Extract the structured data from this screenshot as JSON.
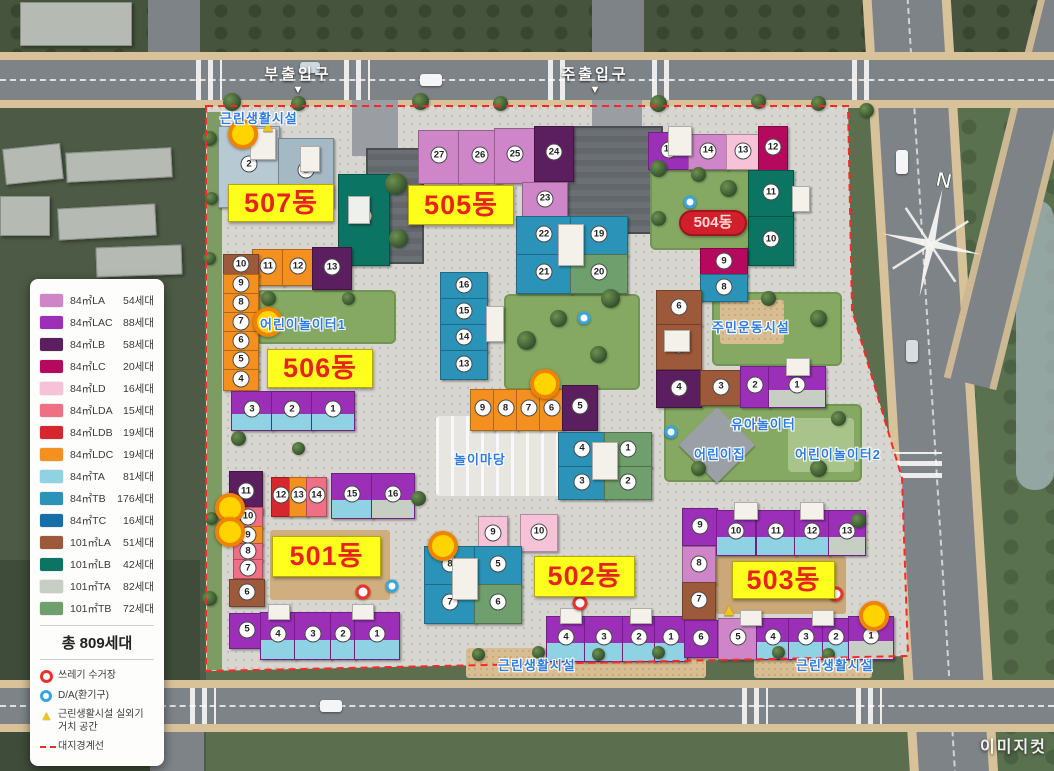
{
  "legend": {
    "unit_types": [
      {
        "label": "84㎡LA",
        "count": "54세대",
        "color": "#cf86c9"
      },
      {
        "label": "84㎡LAC",
        "count": "88세대",
        "color": "#9c2fb8"
      },
      {
        "label": "84㎡LB",
        "count": "58세대",
        "color": "#5b1e5e"
      },
      {
        "label": "84㎡LC",
        "count": "20세대",
        "color": "#b5095e"
      },
      {
        "label": "84㎡LD",
        "count": "16세대",
        "color": "#f6c2d7"
      },
      {
        "label": "84㎡LDA",
        "count": "15세대",
        "color": "#ef6f85"
      },
      {
        "label": "84㎡LDB",
        "count": "19세대",
        "color": "#d7272e"
      },
      {
        "label": "84㎡LDC",
        "count": "19세대",
        "color": "#f39020"
      },
      {
        "label": "84㎡TA",
        "count": "81세대",
        "color": "#8ed2e3"
      },
      {
        "label": "84㎡TB",
        "count": "176세대",
        "color": "#2b93b8"
      },
      {
        "label": "84㎡TC",
        "count": "16세대",
        "color": "#176fa9"
      },
      {
        "label": "101㎡LA",
        "count": "51세대",
        "color": "#9d5a3a"
      },
      {
        "label": "101㎡LB",
        "count": "42세대",
        "color": "#0c7462"
      },
      {
        "label": "101㎡TA",
        "count": "82세대",
        "color": "#c7cfc5"
      },
      {
        "label": "101㎡TB",
        "count": "72세대",
        "color": "#6f9f6c"
      }
    ],
    "total_label": "총 809세대",
    "symbols": [
      {
        "icon": "trash-collection-marker",
        "label": "쓰레기 수거장",
        "color": "#e8332a"
      },
      {
        "icon": "vent-marker",
        "label": "D/A(환기구)",
        "color": "#3aa5dc"
      },
      {
        "icon": "outdoor-unit-area-marker",
        "label": "근린생활시설 실외기 거치 공간",
        "color": "#f2c51d"
      },
      {
        "icon": "site-boundary-line",
        "label": "대지경계선",
        "color": "#e8332a"
      }
    ]
  },
  "entrances": {
    "secondary": "부출입구",
    "main": "주출입구",
    "arrow": "▼"
  },
  "building_labels": {
    "b501": "501동",
    "b502": "502동",
    "b503": "503동",
    "b504": "504동",
    "b505": "505동",
    "b506": "506동",
    "b507": "507동"
  },
  "facilities": {
    "neighborhood_top": "근린생활시설",
    "playground1": "어린이놀이터1",
    "play_yard": "놀이마당",
    "residents_sports": "주민운동시설",
    "toddler_playground": "유아놀이터",
    "daycare": "어린이집",
    "playground2": "어린이놀이터2",
    "neighborhood_bottom_left": "근린생활시설",
    "neighborhood_bottom_right": "근린생활시설"
  },
  "compass_north": "N",
  "watermark": "이미지컷",
  "map_blocks": [
    {
      "n": "2",
      "x": 218,
      "y": 126,
      "w": 60,
      "h": 80,
      "c": "#b7c9d3"
    },
    {
      "n": "1",
      "x": 278,
      "y": 138,
      "w": 54,
      "h": 68,
      "c": "#a5b9c4"
    },
    {
      "n": "",
      "x": 250,
      "y": 128,
      "w": 24,
      "h": 30,
      "c": "#f3f1ea"
    },
    {
      "n": "",
      "x": 300,
      "y": 146,
      "w": 18,
      "h": 24,
      "c": "#f3f1ea"
    },
    {
      "n": "16",
      "x": 338,
      "y": 174,
      "w": 50,
      "h": 90,
      "c": "#0c7462"
    },
    {
      "n": "",
      "x": 348,
      "y": 196,
      "w": 20,
      "h": 26,
      "c": "#eef0ec"
    },
    {
      "n": "11",
      "x": 252,
      "y": 249,
      "w": 30,
      "h": 35,
      "c": "#f39020"
    },
    {
      "n": "12",
      "x": 282,
      "y": 249,
      "w": 30,
      "h": 35,
      "c": "#f39020"
    },
    {
      "n": "13",
      "x": 312,
      "y": 247,
      "w": 38,
      "h": 41,
      "c": "#5b1e5e"
    },
    {
      "n": "10",
      "x": 223,
      "y": 254,
      "w": 34,
      "h": 20,
      "c": "#9d5a3a"
    },
    {
      "n": "9",
      "x": 223,
      "y": 274,
      "w": 34,
      "h": 19,
      "c": "#f39020"
    },
    {
      "n": "8",
      "x": 223,
      "y": 293,
      "w": 34,
      "h": 19,
      "c": "#f39020"
    },
    {
      "n": "7",
      "x": 223,
      "y": 312,
      "w": 34,
      "h": 19,
      "c": "#f39020"
    },
    {
      "n": "6",
      "x": 223,
      "y": 331,
      "w": 34,
      "h": 19,
      "c": "#f39020"
    },
    {
      "n": "5",
      "x": 223,
      "y": 350,
      "w": 34,
      "h": 19,
      "c": "#f39020"
    },
    {
      "n": "4",
      "x": 223,
      "y": 369,
      "w": 34,
      "h": 20,
      "c": "#f39020"
    },
    {
      "n": "3",
      "x": 231,
      "y": 391,
      "w": 40,
      "h": 38,
      "c": "#9c2fb8",
      "l": "#8ed2e3"
    },
    {
      "n": "2",
      "x": 271,
      "y": 391,
      "w": 40,
      "h": 38,
      "c": "#9c2fb8",
      "l": "#8ed2e3"
    },
    {
      "n": "1",
      "x": 311,
      "y": 391,
      "w": 42,
      "h": 38,
      "c": "#9c2fb8",
      "l": "#8ed2e3"
    },
    {
      "n": "27",
      "x": 418,
      "y": 130,
      "w": 40,
      "h": 52,
      "c": "#cf86c9"
    },
    {
      "n": "26",
      "x": 458,
      "y": 130,
      "w": 42,
      "h": 52,
      "c": "#cf86c9"
    },
    {
      "n": "25",
      "x": 494,
      "y": 128,
      "w": 40,
      "h": 54,
      "c": "#cf86c9"
    },
    {
      "n": "24",
      "x": 534,
      "y": 126,
      "w": 38,
      "h": 54,
      "c": "#5b1e5e"
    },
    {
      "n": "23",
      "x": 522,
      "y": 182,
      "w": 44,
      "h": 34,
      "c": "#cf86c9"
    },
    {
      "n": "22",
      "x": 516,
      "y": 216,
      "w": 54,
      "h": 38,
      "c": "#2b93b8"
    },
    {
      "n": "19",
      "x": 570,
      "y": 216,
      "w": 56,
      "h": 38,
      "c": "#2b93b8"
    },
    {
      "n": "21",
      "x": 516,
      "y": 254,
      "w": 54,
      "h": 38,
      "c": "#2b93b8"
    },
    {
      "n": "20",
      "x": 570,
      "y": 254,
      "w": 56,
      "h": 38,
      "c": "#6f9f6c"
    },
    {
      "n": "",
      "x": 558,
      "y": 224,
      "w": 24,
      "h": 40,
      "c": "#f3f1ea"
    },
    {
      "n": "16",
      "x": 440,
      "y": 272,
      "w": 46,
      "h": 26,
      "c": "#2b93b8"
    },
    {
      "n": "15",
      "x": 440,
      "y": 298,
      "w": 46,
      "h": 26,
      "c": "#2b93b8"
    },
    {
      "n": "14",
      "x": 440,
      "y": 324,
      "w": 46,
      "h": 26,
      "c": "#2b93b8"
    },
    {
      "n": "13",
      "x": 440,
      "y": 350,
      "w": 46,
      "h": 28,
      "c": "#2b93b8"
    },
    {
      "n": "",
      "x": 486,
      "y": 306,
      "w": 16,
      "h": 34,
      "c": "#f3f1ea"
    },
    {
      "n": "9",
      "x": 470,
      "y": 389,
      "w": 23,
      "h": 40,
      "c": "#f39020"
    },
    {
      "n": "8",
      "x": 493,
      "y": 389,
      "w": 23,
      "h": 40,
      "c": "#f39020"
    },
    {
      "n": "7",
      "x": 516,
      "y": 389,
      "w": 23,
      "h": 40,
      "c": "#f39020"
    },
    {
      "n": "6",
      "x": 539,
      "y": 389,
      "w": 23,
      "h": 40,
      "c": "#f39020"
    },
    {
      "n": "5",
      "x": 562,
      "y": 385,
      "w": 34,
      "h": 44,
      "c": "#5b1e5e"
    },
    {
      "n": "4",
      "x": 558,
      "y": 432,
      "w": 46,
      "h": 34,
      "c": "#2b93b8"
    },
    {
      "n": "1",
      "x": 604,
      "y": 432,
      "w": 46,
      "h": 34,
      "c": "#6f9f6c"
    },
    {
      "n": "3",
      "x": 558,
      "y": 466,
      "w": 46,
      "h": 32,
      "c": "#2b93b8"
    },
    {
      "n": "2",
      "x": 604,
      "y": 466,
      "w": 46,
      "h": 32,
      "c": "#6f9f6c"
    },
    {
      "n": "",
      "x": 592,
      "y": 442,
      "w": 24,
      "h": 36,
      "c": "#f3f1ea"
    },
    {
      "n": "11",
      "x": 229,
      "y": 471,
      "w": 32,
      "h": 42,
      "c": "#5b1e5e"
    },
    {
      "n": "12",
      "x": 271,
      "y": 477,
      "w": 18,
      "h": 38,
      "c": "#d7272e"
    },
    {
      "n": "13",
      "x": 289,
      "y": 477,
      "w": 17,
      "h": 38,
      "c": "#f39020"
    },
    {
      "n": "14",
      "x": 306,
      "y": 477,
      "w": 19,
      "h": 38,
      "c": "#ef6f85"
    },
    {
      "n": "15",
      "x": 331,
      "y": 473,
      "w": 40,
      "h": 44,
      "c": "#9c2fb8",
      "l": "#8ed2e3"
    },
    {
      "n": "16",
      "x": 371,
      "y": 473,
      "w": 42,
      "h": 44,
      "c": "#9c2fb8",
      "l": "#c7cfc5"
    },
    {
      "n": "10",
      "x": 233,
      "y": 507,
      "w": 28,
      "h": 19,
      "c": "#ef6f85"
    },
    {
      "n": "9",
      "x": 233,
      "y": 526,
      "w": 28,
      "h": 17,
      "c": "#f39020"
    },
    {
      "n": "8",
      "x": 233,
      "y": 543,
      "w": 28,
      "h": 16,
      "c": "#ef6f85"
    },
    {
      "n": "7",
      "x": 233,
      "y": 559,
      "w": 28,
      "h": 18,
      "c": "#ef6f85"
    },
    {
      "n": "6",
      "x": 229,
      "y": 579,
      "w": 34,
      "h": 26,
      "c": "#9d5a3a"
    },
    {
      "n": "5",
      "x": 229,
      "y": 613,
      "w": 34,
      "h": 34,
      "c": "#9c2fb8"
    },
    {
      "n": "4",
      "x": 260,
      "y": 612,
      "w": 34,
      "h": 46,
      "c": "#9c2fb8",
      "l": "#8ed2e3"
    },
    {
      "n": "3",
      "x": 294,
      "y": 612,
      "w": 36,
      "h": 46,
      "c": "#9c2fb8",
      "l": "#8ed2e3"
    },
    {
      "n": "2",
      "x": 330,
      "y": 612,
      "w": 24,
      "h": 46,
      "c": "#9c2fb8",
      "l": "#8ed2e3"
    },
    {
      "n": "1",
      "x": 354,
      "y": 612,
      "w": 44,
      "h": 46,
      "c": "#9c2fb8",
      "l": "#8ed2e3"
    },
    {
      "n": "",
      "x": 268,
      "y": 604,
      "w": 20,
      "h": 14,
      "c": "#f3f1ea"
    },
    {
      "n": "",
      "x": 352,
      "y": 604,
      "w": 20,
      "h": 14,
      "c": "#f3f1ea"
    },
    {
      "n": "9",
      "x": 478,
      "y": 516,
      "w": 28,
      "h": 34,
      "c": "#f6c2d7"
    },
    {
      "n": "10",
      "x": 520,
      "y": 514,
      "w": 36,
      "h": 36,
      "c": "#f6c2d7"
    },
    {
      "n": "8",
      "x": 424,
      "y": 546,
      "w": 50,
      "h": 38,
      "c": "#2b93b8"
    },
    {
      "n": "5",
      "x": 474,
      "y": 546,
      "w": 46,
      "h": 38,
      "c": "#2b93b8"
    },
    {
      "n": "7",
      "x": 424,
      "y": 584,
      "w": 50,
      "h": 38,
      "c": "#2b93b8"
    },
    {
      "n": "6",
      "x": 474,
      "y": 584,
      "w": 46,
      "h": 38,
      "c": "#6f9f6c"
    },
    {
      "n": "",
      "x": 452,
      "y": 558,
      "w": 24,
      "h": 40,
      "c": "#f3f1ea"
    },
    {
      "n": "4",
      "x": 546,
      "y": 616,
      "w": 38,
      "h": 44,
      "c": "#9c2fb8",
      "l": "#8ed2e3"
    },
    {
      "n": "3",
      "x": 584,
      "y": 616,
      "w": 38,
      "h": 44,
      "c": "#9c2fb8",
      "l": "#8ed2e3"
    },
    {
      "n": "2",
      "x": 622,
      "y": 616,
      "w": 32,
      "h": 44,
      "c": "#9c2fb8",
      "l": "#8ed2e3"
    },
    {
      "n": "1",
      "x": 654,
      "y": 616,
      "w": 32,
      "h": 44,
      "c": "#9c2fb8",
      "l": "#8ed2e3"
    },
    {
      "n": "",
      "x": 560,
      "y": 608,
      "w": 20,
      "h": 14,
      "c": "#f3f1ea"
    },
    {
      "n": "",
      "x": 630,
      "y": 608,
      "w": 20,
      "h": 14,
      "c": "#f3f1ea"
    },
    {
      "n": "9",
      "x": 682,
      "y": 508,
      "w": 34,
      "h": 36,
      "c": "#9c2fb8"
    },
    {
      "n": "8",
      "x": 682,
      "y": 546,
      "w": 32,
      "h": 36,
      "c": "#cf86c9"
    },
    {
      "n": "7",
      "x": 682,
      "y": 582,
      "w": 32,
      "h": 36,
      "c": "#9d5a3a"
    },
    {
      "n": "6",
      "x": 684,
      "y": 620,
      "w": 32,
      "h": 36,
      "c": "#9c2fb8"
    },
    {
      "n": "10",
      "x": 716,
      "y": 510,
      "w": 38,
      "h": 44,
      "c": "#9c2fb8",
      "l": "#8ed2e3"
    },
    {
      "n": "11",
      "x": 756,
      "y": 510,
      "w": 38,
      "h": 44,
      "c": "#9c2fb8",
      "l": "#8ed2e3"
    },
    {
      "n": "12",
      "x": 794,
      "y": 510,
      "w": 34,
      "h": 44,
      "c": "#9c2fb8",
      "l": "#8ed2e3"
    },
    {
      "n": "13",
      "x": 828,
      "y": 510,
      "w": 36,
      "h": 44,
      "c": "#9c2fb8",
      "l": "#c7cfc5"
    },
    {
      "n": "5",
      "x": 718,
      "y": 618,
      "w": 38,
      "h": 40,
      "c": "#cf86c9"
    },
    {
      "n": "4",
      "x": 756,
      "y": 618,
      "w": 32,
      "h": 40,
      "c": "#9c2fb8",
      "l": "#8ed2e3"
    },
    {
      "n": "3",
      "x": 788,
      "y": 618,
      "w": 34,
      "h": 40,
      "c": "#9c2fb8",
      "l": "#8ed2e3"
    },
    {
      "n": "2",
      "x": 822,
      "y": 618,
      "w": 26,
      "h": 40,
      "c": "#9c2fb8",
      "l": "#8ed2e3"
    },
    {
      "n": "1",
      "x": 848,
      "y": 616,
      "w": 44,
      "h": 42,
      "c": "#9c2fb8",
      "l": "#c7cfc5"
    },
    {
      "n": "",
      "x": 734,
      "y": 502,
      "w": 22,
      "h": 16,
      "c": "#f3f1ea"
    },
    {
      "n": "",
      "x": 800,
      "y": 502,
      "w": 22,
      "h": 16,
      "c": "#f3f1ea"
    },
    {
      "n": "",
      "x": 740,
      "y": 610,
      "w": 20,
      "h": 14,
      "c": "#f3f1ea"
    },
    {
      "n": "",
      "x": 812,
      "y": 610,
      "w": 20,
      "h": 14,
      "c": "#f3f1ea"
    },
    {
      "n": "15",
      "x": 648,
      "y": 132,
      "w": 40,
      "h": 36,
      "c": "#9c2fb8"
    },
    {
      "n": "14",
      "x": 688,
      "y": 134,
      "w": 38,
      "h": 34,
      "c": "#cf86c9"
    },
    {
      "n": "13",
      "x": 726,
      "y": 134,
      "w": 32,
      "h": 34,
      "c": "#f6c2d7"
    },
    {
      "n": "12",
      "x": 758,
      "y": 126,
      "w": 28,
      "h": 44,
      "c": "#b5095e"
    },
    {
      "n": "11",
      "x": 748,
      "y": 170,
      "w": 44,
      "h": 46,
      "c": "#0c7462"
    },
    {
      "n": "10",
      "x": 748,
      "y": 216,
      "w": 44,
      "h": 48,
      "c": "#0c7462"
    },
    {
      "n": "",
      "x": 668,
      "y": 126,
      "w": 22,
      "h": 28,
      "c": "#f3f1ea"
    },
    {
      "n": "",
      "x": 792,
      "y": 186,
      "w": 16,
      "h": 24,
      "c": "#f3f1ea"
    },
    {
      "n": "9",
      "x": 700,
      "y": 248,
      "w": 46,
      "h": 26,
      "c": "#b5095e"
    },
    {
      "n": "8",
      "x": 700,
      "y": 274,
      "w": 46,
      "h": 26,
      "c": "#2b93b8"
    },
    {
      "n": "6",
      "x": 656,
      "y": 290,
      "w": 44,
      "h": 34,
      "c": "#9d5a3a"
    },
    {
      "n": "5",
      "x": 656,
      "y": 324,
      "w": 44,
      "h": 44,
      "c": "#9d5a3a"
    },
    {
      "n": "",
      "x": 664,
      "y": 330,
      "w": 24,
      "h": 20,
      "c": "#f3f1ea"
    },
    {
      "n": "4",
      "x": 656,
      "y": 370,
      "w": 44,
      "h": 36,
      "c": "#5b1e5e"
    },
    {
      "n": "3",
      "x": 700,
      "y": 370,
      "w": 40,
      "h": 34,
      "c": "#9d5a3a"
    },
    {
      "n": "2",
      "x": 740,
      "y": 366,
      "w": 28,
      "h": 40,
      "c": "#9c2fb8"
    },
    {
      "n": "1",
      "x": 768,
      "y": 366,
      "w": 56,
      "h": 40,
      "c": "#9c2fb8",
      "l": "#c7cfc5"
    },
    {
      "n": "",
      "x": 786,
      "y": 358,
      "w": 22,
      "h": 16,
      "c": "#f3f1ea"
    }
  ],
  "markers": {
    "highlight_points": [
      [
        243,
        134
      ],
      [
        268,
        322
      ],
      [
        545,
        384
      ],
      [
        443,
        546
      ],
      [
        230,
        508
      ],
      [
        230,
        532
      ],
      [
        874,
        616
      ]
    ],
    "trash_points": [
      [
        363,
        592
      ],
      [
        580,
        603
      ],
      [
        836,
        594
      ]
    ],
    "vent_points": [
      [
        690,
        202
      ],
      [
        671,
        432
      ],
      [
        392,
        586
      ],
      [
        584,
        318
      ]
    ],
    "outdoor_unit_points": [
      [
        268,
        126
      ],
      [
        729,
        610
      ]
    ]
  }
}
